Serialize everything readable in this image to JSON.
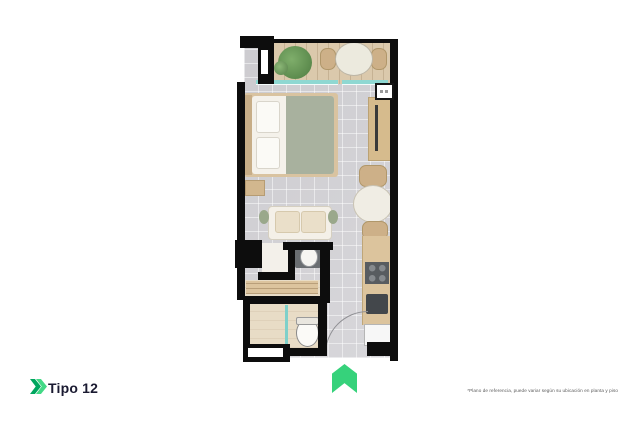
{
  "page": {
    "background": "#ffffff"
  },
  "footer": {
    "type_label": "Tipo 12",
    "disclaimer": "*Plano de referencia, puede variar según su ubicación en planta y piso"
  },
  "icons": {
    "brand_chevron": "double-chevron-right-icon",
    "orientation_arrow": "up-arrow-icon"
  },
  "colors": {
    "accent_green": "#36d27b",
    "accent_green_dark": "#00a65f",
    "wall": "#0d0d0d",
    "floor_tile": "#d5d4d8",
    "balcony_wood": "#dbc9ac",
    "window_glass": "#8fd8d2",
    "bed_blanket": "#a8b19e",
    "label_text": "#1a1a31",
    "disclaimer_text": "#5a5a5a"
  },
  "floorplan": {
    "unit_type": "Tipo 12",
    "rooms": [
      {
        "name": "balcony",
        "furniture": [
          "plant",
          "outdoor-table",
          "outdoor-chair",
          "outdoor-chair"
        ]
      },
      {
        "name": "bedroom",
        "furniture": [
          "bed",
          "pillows",
          "nightstand",
          "desk",
          "desk-chair"
        ]
      },
      {
        "name": "living-dining",
        "furniture": [
          "sofa",
          "dining-table",
          "dining-chair",
          "dining-chair"
        ]
      },
      {
        "name": "bathroom",
        "furniture": [
          "sink",
          "toilet",
          "shower",
          "closet"
        ]
      },
      {
        "name": "kitchen",
        "furniture": [
          "counter",
          "stove",
          "oven",
          "fridge"
        ]
      },
      {
        "name": "entrance",
        "furniture": [
          "door-swing"
        ]
      }
    ]
  }
}
